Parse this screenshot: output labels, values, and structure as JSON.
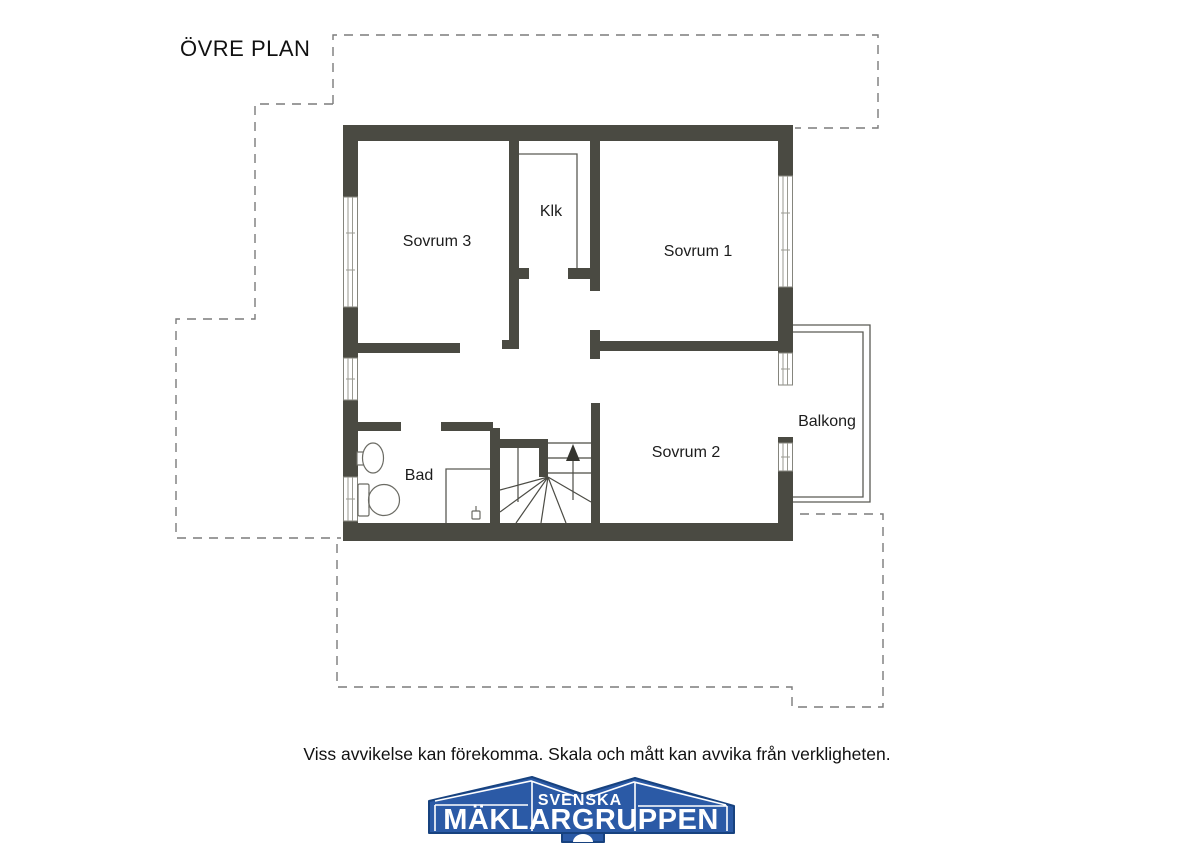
{
  "title": "ÖVRE PLAN",
  "rooms": {
    "sovrum3": "Sovrum 3",
    "klk": "Klk",
    "sovrum1": "Sovrum 1",
    "bad": "Bad",
    "sovrum2": "Sovrum 2",
    "balkong": "Balkong"
  },
  "footer": {
    "disclaimer": "Viss avvikelse kan förekomma. Skala och mått kan avvika från verkligheten."
  },
  "logo": {
    "top_text": "SVENSKA",
    "bottom_text": "MÄKLARGRUPPEN"
  },
  "colors": {
    "wall": "#4a4a42",
    "thin_line": "#5b5b54",
    "dashed_line": "#7b7b7b",
    "logo_blue": "#2b5aa6",
    "logo_dark_blue": "#17427f",
    "text": "#111111"
  }
}
